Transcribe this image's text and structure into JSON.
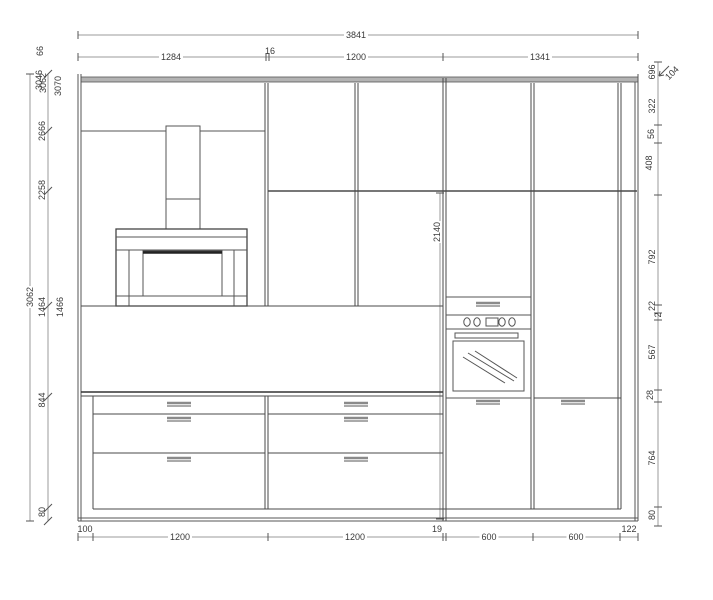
{
  "colors": {
    "background": "#ffffff",
    "cabinet_line": "#4a4a4a",
    "dim_line": "#9b9b9b",
    "dim_text": "#3a3a3a",
    "top_edge_fill": "#b3b3b3"
  },
  "dimensions": {
    "top": {
      "total": "3841",
      "segments": [
        "1284",
        "16",
        "1200",
        "1341"
      ]
    },
    "bottom": {
      "segments": [
        "100",
        "1200",
        "1200",
        "19",
        "600",
        "600",
        "122"
      ]
    },
    "left": {
      "total": "3062",
      "levels": [
        "2666",
        "2258",
        "1464",
        "1466",
        "844",
        "80"
      ],
      "top_cluster": [
        "66",
        "3046",
        "3062",
        "3070"
      ]
    },
    "middle": {
      "tall_unit_height": "2140"
    },
    "right": {
      "levels": [
        "696",
        "104",
        "322",
        "56",
        "408",
        "792",
        "22",
        "2",
        "567",
        "28",
        "764",
        "80"
      ]
    }
  }
}
